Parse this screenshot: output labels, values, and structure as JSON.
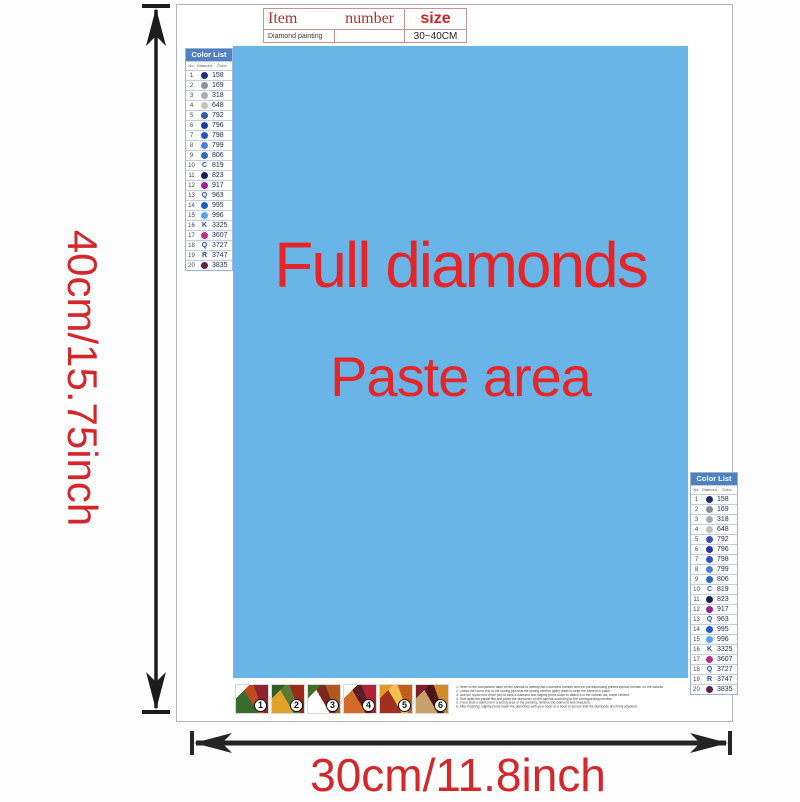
{
  "theme": {
    "paste_bg": "#6ab5e7",
    "accent_red": "#e62529",
    "dim_label_red": "#d4262b",
    "list_header_bg": "#4f80c0",
    "arrow_color": "#1c1c1c"
  },
  "spec_table": {
    "header": {
      "item": "Item",
      "number": "number",
      "size": "size"
    },
    "row": {
      "item": "Diamond painting",
      "number": "",
      "size": "30~40CM"
    }
  },
  "paste_area": {
    "line1": "Full diamonds",
    "line2": "Paste area"
  },
  "dimensions": {
    "height_label": "40cm/15.75inch",
    "width_label": "30cm/11.8inch"
  },
  "color_list": {
    "title": "Color List",
    "columns": [
      "No.",
      "Diamond",
      "Color"
    ],
    "rows": [
      {
        "no": "1",
        "symbol_type": "circle",
        "symbol_color": "#1e2f6d",
        "code": "158"
      },
      {
        "no": "2",
        "symbol_type": "circle",
        "symbol_color": "#8a8f98",
        "code": "169"
      },
      {
        "no": "3",
        "symbol_type": "circle",
        "symbol_color": "#a9adb3",
        "code": "318"
      },
      {
        "no": "4",
        "symbol_type": "circle",
        "symbol_color": "#bfc2ba",
        "code": "648"
      },
      {
        "no": "5",
        "symbol_type": "circle",
        "symbol_color": "#3a57a7",
        "code": "792"
      },
      {
        "no": "6",
        "symbol_type": "circle",
        "symbol_color": "#20379e",
        "code": "796"
      },
      {
        "no": "7",
        "symbol_type": "circle",
        "symbol_color": "#2a52c0",
        "code": "798"
      },
      {
        "no": "8",
        "symbol_type": "circle",
        "symbol_color": "#4e7fd6",
        "code": "799"
      },
      {
        "no": "9",
        "symbol_type": "circle",
        "symbol_color": "#2f6cb8",
        "code": "806"
      },
      {
        "no": "10",
        "symbol_type": "letter",
        "symbol_char": "C",
        "code": "819"
      },
      {
        "no": "11",
        "symbol_type": "circle",
        "symbol_color": "#16224e",
        "code": "823"
      },
      {
        "no": "12",
        "symbol_type": "circle",
        "symbol_color": "#9c2390",
        "code": "917"
      },
      {
        "no": "13",
        "symbol_type": "letter",
        "symbol_char": "Q",
        "code": "963"
      },
      {
        "no": "14",
        "symbol_type": "circle",
        "symbol_color": "#1a5fc8",
        "code": "995"
      },
      {
        "no": "15",
        "symbol_type": "circle",
        "symbol_color": "#4da9e8",
        "code": "996"
      },
      {
        "no": "16",
        "symbol_type": "letter",
        "symbol_char": "K",
        "code": "3325"
      },
      {
        "no": "17",
        "symbol_type": "circle",
        "symbol_color": "#b8308f",
        "code": "3607"
      },
      {
        "no": "18",
        "symbol_type": "letter",
        "symbol_char": "Q",
        "code": "3727"
      },
      {
        "no": "19",
        "symbol_type": "letter",
        "symbol_char": "R",
        "code": "3747"
      },
      {
        "no": "20",
        "symbol_type": "circle",
        "symbol_color": "#5c2150",
        "code": "3835"
      }
    ]
  },
  "steps": {
    "thumbnails": [
      {
        "num": "1",
        "colors": [
          "#ffffff",
          "#8e2230",
          "#3a6b2e",
          "#c24a22"
        ]
      },
      {
        "num": "2",
        "colors": [
          "#2f5e27",
          "#9c2a1c",
          "#e0a22a",
          "#5a7a30"
        ]
      },
      {
        "num": "3",
        "colors": [
          "#446b2a",
          "#b05a1e",
          "#ffffff",
          "#7a2a1e"
        ]
      },
      {
        "num": "4",
        "colors": [
          "#ffffff",
          "#b02438",
          "#d46a28",
          "#5a1c24"
        ]
      },
      {
        "num": "5",
        "colors": [
          "#e09a28",
          "#c06018",
          "#a03020",
          "#f0c050"
        ]
      },
      {
        "num": "6",
        "colors": [
          "#7a1e2a",
          "#d08a28",
          "#caa06a",
          "#4a1418"
        ]
      }
    ]
  },
  "instructions": {
    "lines": [
      "Refer to the comparison table on the canvas to identify each diamond number and the corresponding printed symbol number on the canvas.",
      "Check the round end of the tooling pen that the tooling cement (wax) holds to keep the cement in place.",
      "Use the round end of the pen to stick a diamond and slightly press down to attach it to the canvas dot, some cement.",
      "Tear apart the partial film and place the diamonds on the canvas according to the corresponding number.",
      "If you stick a diamond in a wrong area of the painting, remove the diamond with tweezers.",
      "After finishing, slightly press down the diamonds with your hand or a book to ensure that the diamonds are firmly attached."
    ]
  }
}
